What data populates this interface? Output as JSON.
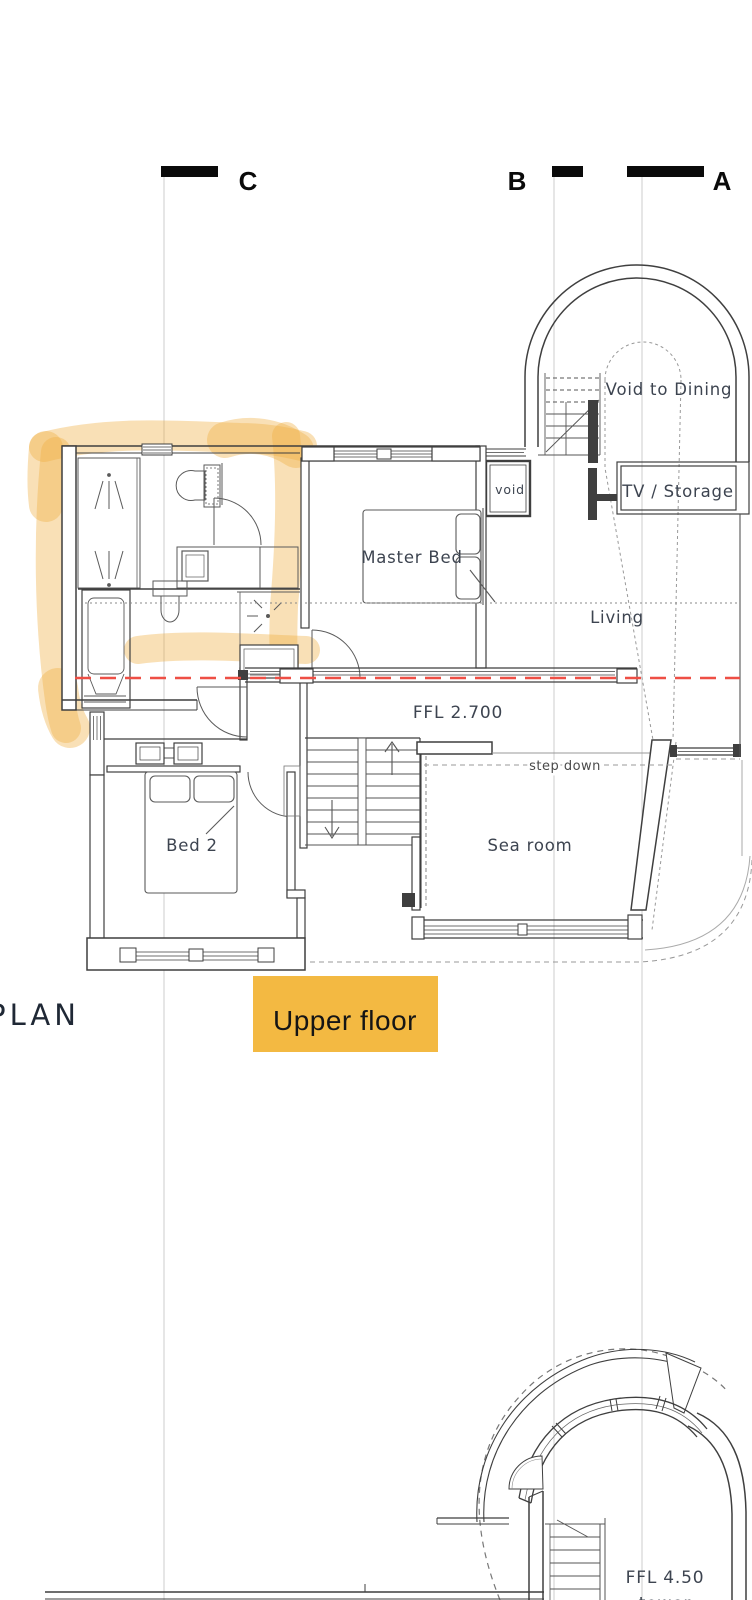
{
  "colors": {
    "wall": "#3f3f3f",
    "fixture": "#5a5a5a",
    "light_line": "#aaaaaa",
    "dashed_gray": "#888888",
    "section_line": "#cccccc",
    "red_line": "#ee4f45",
    "highlight": "#f0ad3e",
    "tag_bg": "#f3b942",
    "label_text": "#3d4450"
  },
  "section_markers": {
    "c": "C",
    "b": "B",
    "a": "A"
  },
  "upper_plan": {
    "labels": {
      "void_to_dining": "Void to Dining",
      "tv_storage": "TV / Storage",
      "void": "void",
      "master_bed": "Master Bed",
      "living": "Living",
      "ffl": "FFL 2.700",
      "step_down": "step down",
      "sea_room": "Sea room",
      "bed_2": "Bed 2"
    }
  },
  "titles": {
    "plan": "PLAN",
    "floor_tag": "Upper floor"
  },
  "lower_plan": {
    "labels": {
      "ffl": "FFL 4.50",
      "tower": "tower"
    }
  }
}
